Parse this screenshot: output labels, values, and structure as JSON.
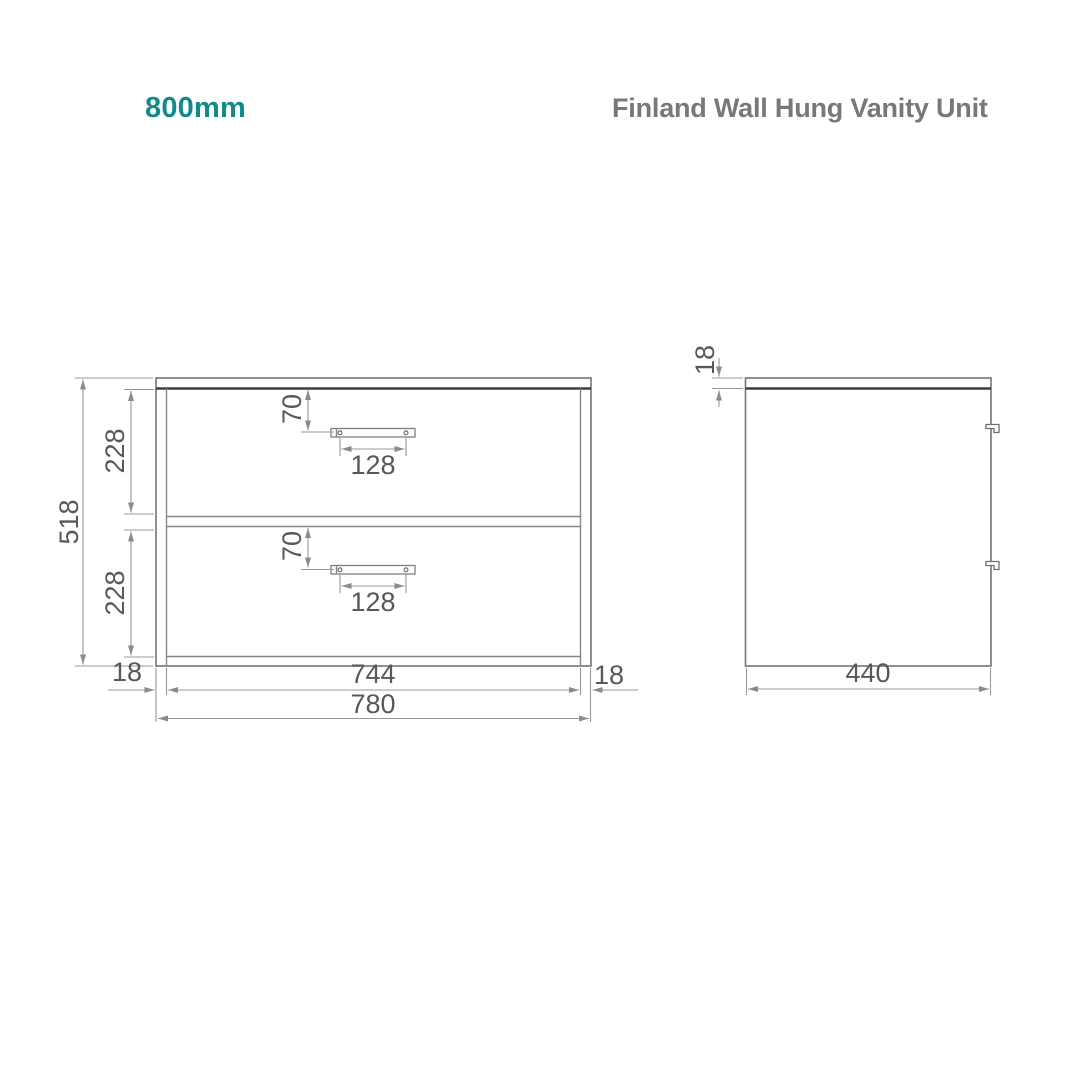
{
  "header": {
    "size_label": "800mm",
    "product_title": "Finland Wall Hung Vanity Unit"
  },
  "colors": {
    "accent_teal": "#128a8a",
    "title_gray": "#77787b",
    "drawing_line_gray": "#85868a",
    "dimension_text_gray": "#57585a",
    "countertop_edge_dark": "#3f3f41"
  },
  "front_view": {
    "dimensions": {
      "overall_height": "518",
      "top_drawer_height": "228",
      "bottom_drawer_height": "228",
      "top_handle_offset": "70",
      "bottom_handle_offset": "70",
      "top_handle_width": "128",
      "bottom_handle_width": "128",
      "left_panel_thickness": "18",
      "inner_width": "744",
      "right_panel_thickness": "18",
      "overall_width": "780"
    }
  },
  "side_view": {
    "dimensions": {
      "worktop_thickness": "18",
      "overall_depth": "440"
    }
  }
}
